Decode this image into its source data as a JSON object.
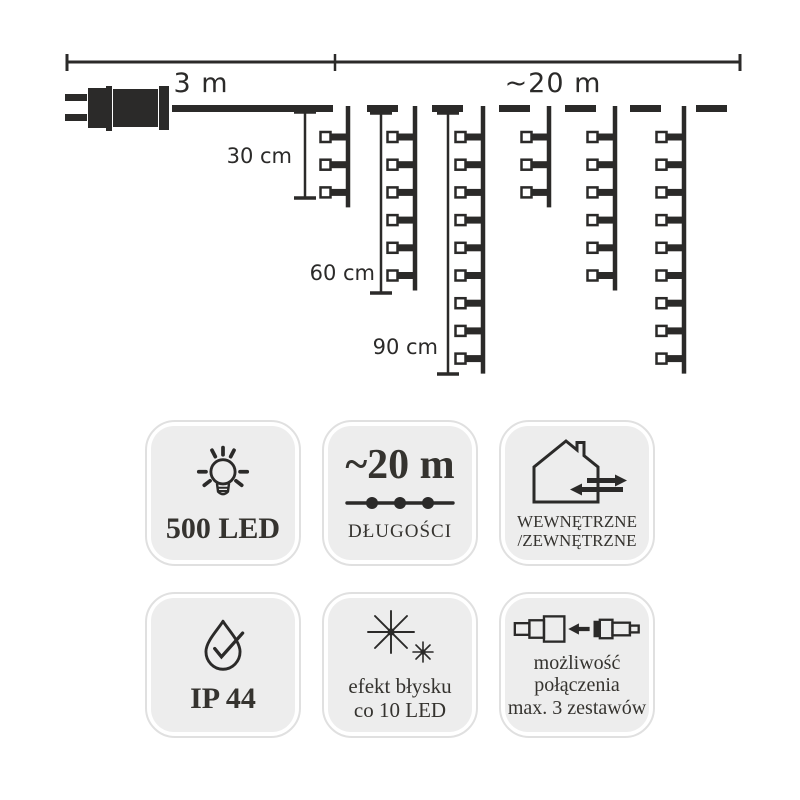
{
  "colors": {
    "ink": "#2b2a29",
    "badge_bg": "#ededed",
    "badge_border": "#e0e0e0",
    "background": "#ffffff"
  },
  "diagram": {
    "dimension": {
      "y": 62,
      "x1": 67,
      "x2": 740,
      "mid": 335,
      "label_left": "3 m",
      "label_right": "~20 m"
    },
    "plug": {
      "rects": [
        [
          65,
          94,
          22,
          7
        ],
        [
          65,
          114,
          22,
          7
        ],
        [
          88,
          88,
          18,
          40
        ],
        [
          106,
          86,
          6,
          45
        ],
        [
          113,
          89,
          45,
          38
        ],
        [
          159,
          86,
          10,
          44
        ]
      ]
    },
    "lead_wire": [
      172,
      105,
      161,
      7
    ],
    "dashes": {
      "y": 105,
      "h": 7,
      "w": 31,
      "xs": [
        367,
        432,
        499,
        565,
        630,
        696
      ]
    },
    "strands": {
      "wire_y": 106,
      "first_led_y": 137,
      "led_spacing": 27.7,
      "tail": 15,
      "items": [
        {
          "x": 348,
          "leds": 3
        },
        {
          "x": 415,
          "leds": 6
        },
        {
          "x": 483,
          "leds": 9
        },
        {
          "x": 549,
          "leds": 3
        },
        {
          "x": 615,
          "leds": 6
        },
        {
          "x": 684,
          "leds": 9
        }
      ]
    },
    "brackets": [
      {
        "x": 305,
        "y1": 112,
        "y2": 198,
        "label": "30 cm"
      },
      {
        "x": 381,
        "y1": 113,
        "y2": 293,
        "label": "60 cm"
      },
      {
        "x": 448,
        "y1": 113,
        "y2": 374,
        "label": "90 cm"
      }
    ]
  },
  "icons": [
    "light-bulb-icon",
    "string-lights-icon",
    "house-indoor-outdoor-icon",
    "droplet-check-icon",
    "sparkle-flash-icon",
    "connector-join-icon"
  ],
  "badges": {
    "led_count": {
      "label": "500 LED"
    },
    "length": {
      "value": "~20 m",
      "caption": "DŁUGOŚCI"
    },
    "placement": {
      "line1": "WEWNĘTRZNE",
      "line2": "/ZEWNĘTRZNE"
    },
    "ip_rating": {
      "label": "IP 44"
    },
    "flash": {
      "line1": "efekt błysku",
      "line2": "co 10 LED"
    },
    "connectable": {
      "line1": "możliwość",
      "line2": "połączenia",
      "line3": "max. 3 zestawów"
    }
  }
}
